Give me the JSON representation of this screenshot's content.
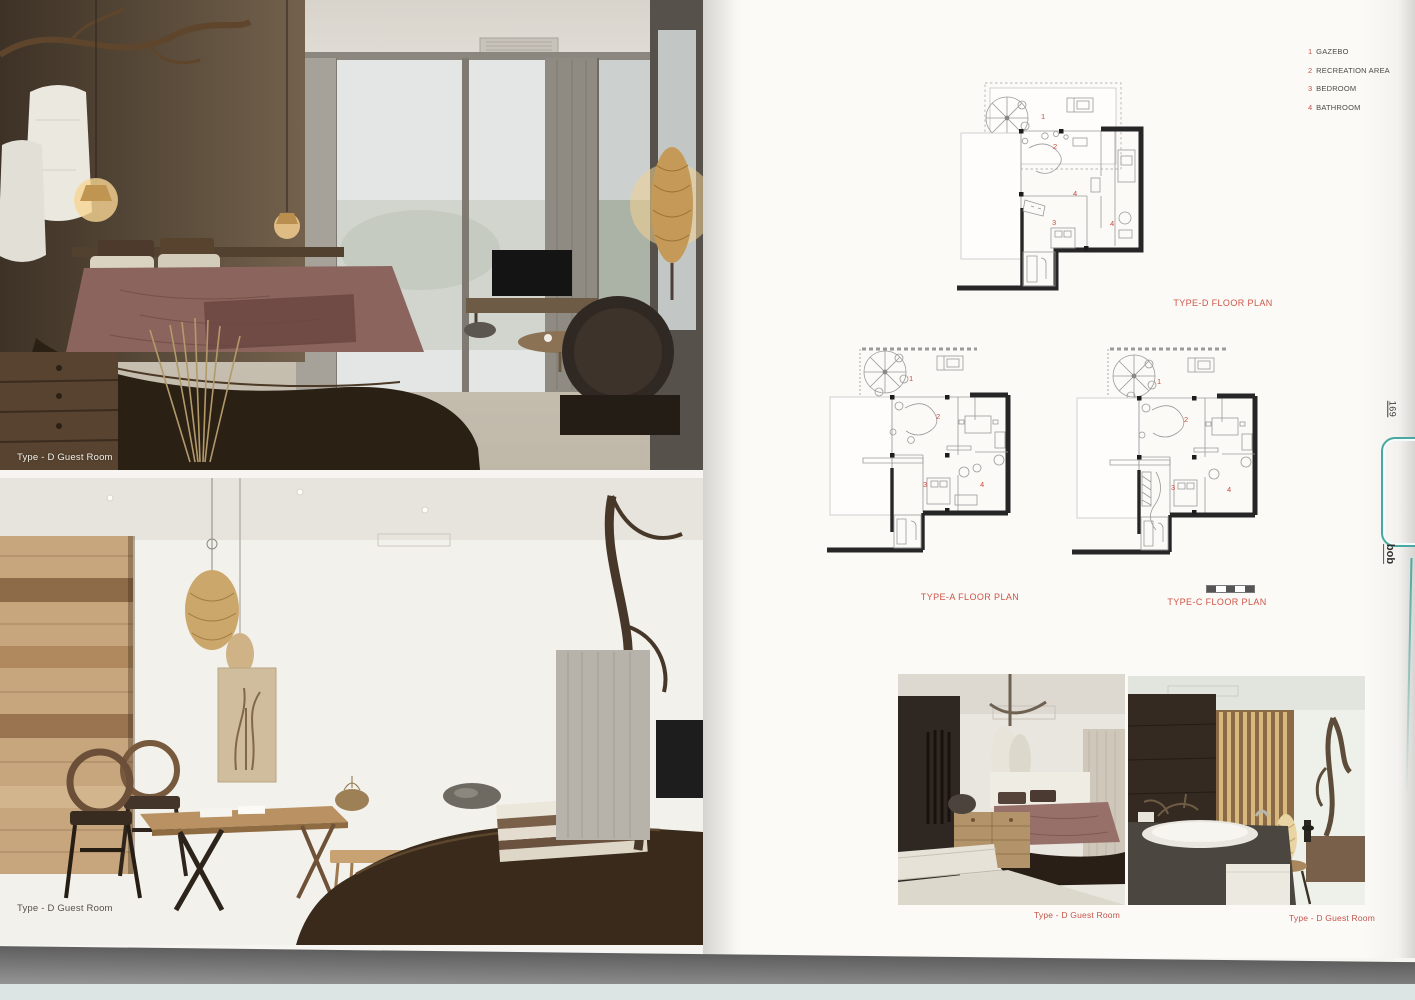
{
  "colors": {
    "accent_red": "#c4544a",
    "edge_teal": "#49a8a1",
    "wall_black": "#262626",
    "scan_gray": "#6e6e6e"
  },
  "legend": {
    "items": [
      {
        "num": "1",
        "label": "GAZEBO"
      },
      {
        "num": "2",
        "label": "RECREATION AREA"
      },
      {
        "num": "3",
        "label": "BEDROOM"
      },
      {
        "num": "4",
        "label": "BATHROOM"
      }
    ]
  },
  "plans": {
    "type_d": {
      "label": "TYPE-D FLOOR PLAN",
      "markers": [
        {
          "num": "1"
        },
        {
          "num": "2"
        },
        {
          "num": "4"
        },
        {
          "num": "3"
        },
        {
          "num": "4"
        }
      ]
    },
    "type_a": {
      "label": "TYPE-A FLOOR PLAN",
      "markers": [
        {
          "num": "1"
        },
        {
          "num": "2"
        },
        {
          "num": "3"
        },
        {
          "num": "4"
        }
      ]
    },
    "type_c": {
      "label": "TYPE-C FLOOR PLAN",
      "markers": [
        {
          "num": "1"
        },
        {
          "num": "2"
        },
        {
          "num": "3"
        },
        {
          "num": "4"
        }
      ]
    }
  },
  "left_page": {
    "top_photo": {
      "caption": "Type - D Guest Room"
    },
    "bottom_photo": {
      "caption": "Type - D Guest Room"
    }
  },
  "right_page": {
    "bottom_left_photo": {
      "caption": "Type - D Guest Room"
    },
    "bottom_right_photo": {
      "caption": "Type - D Guest Room"
    }
  },
  "edge": {
    "page_number": "169",
    "logo": "bob"
  }
}
